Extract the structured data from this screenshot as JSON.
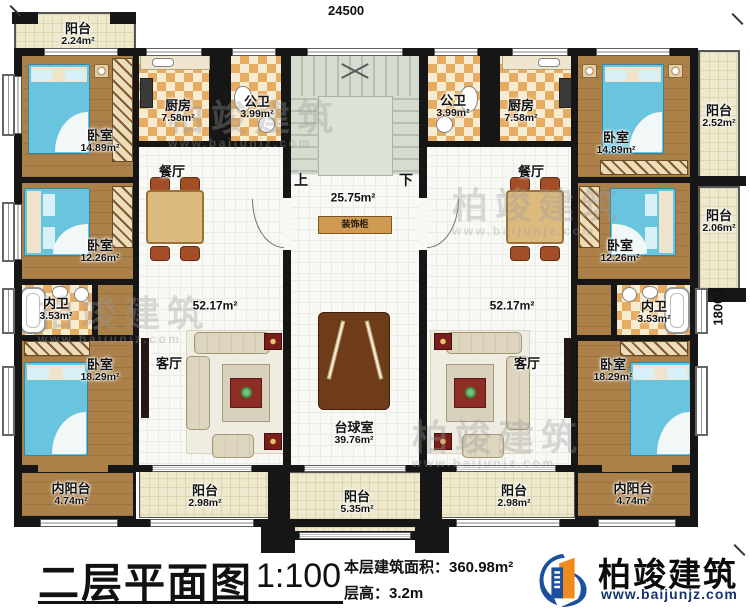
{
  "dimensions": {
    "top": "24500",
    "right": "18000"
  },
  "watermark": {
    "text": "柏竣建筑",
    "url": "www.baijunjz.com"
  },
  "hall": {
    "up": "上",
    "down": "下",
    "area": "25.75m²",
    "cabinet": "装饰柜"
  },
  "rooms": {
    "balcony_tl": {
      "name": "阳台",
      "area": "2.24m²"
    },
    "bedroom_tl": {
      "name": "卧室",
      "area": "14.89m²"
    },
    "kitchen_l": {
      "name": "厨房",
      "area": "7.58m²"
    },
    "bath_l": {
      "name": "公卫",
      "area": "3.99m²"
    },
    "dining_l": {
      "name": "餐厅"
    },
    "bedroom_ml": {
      "name": "卧室",
      "area": "12.26m²"
    },
    "living_l": {
      "name": "客厅",
      "area": "52.17m²"
    },
    "innerbath_l": {
      "name": "内卫",
      "area": "3.53m²"
    },
    "bedroom_bl": {
      "name": "卧室",
      "area": "18.29m²"
    },
    "innerbalcony_l": {
      "name": "内阳台",
      "area": "4.74m²"
    },
    "balcony_bl": {
      "name": "阳台",
      "area": "2.98m²"
    },
    "billiard": {
      "name": "台球室",
      "area": "39.76m²"
    },
    "balcony_bc": {
      "name": "阳台",
      "area": "5.35m²"
    },
    "bath_r": {
      "name": "公卫",
      "area": "3.99m²"
    },
    "kitchen_r": {
      "name": "厨房",
      "area": "7.58m²"
    },
    "bedroom_tr": {
      "name": "卧室",
      "area": "14.89m²"
    },
    "balcony_tr": {
      "name": "阳台",
      "area": "2.52m²"
    },
    "dining_r": {
      "name": "餐厅"
    },
    "bedroom_mr": {
      "name": "卧室",
      "area": "12.26m²"
    },
    "balcony_mr": {
      "name": "阳台",
      "area": "2.06m²"
    },
    "innerbath_r": {
      "name": "内卫",
      "area": "3.53m²"
    },
    "bedroom_br": {
      "name": "卧室",
      "area": "18.29m²"
    },
    "innerbalcony_r": {
      "name": "内阳台",
      "area": "4.74m²"
    },
    "balcony_br": {
      "name": "阳台",
      "area": "2.98m²"
    },
    "living_r": {
      "name": "客厅",
      "area": "52.17m²"
    }
  },
  "titleblock": {
    "title": "二层平面图",
    "scale": "1:100",
    "area_line": "本层建筑面积：360.98m²",
    "height_line": "层高：3.2m",
    "brand": "柏竣建筑",
    "brand_url": "www.baijunjz.com"
  }
}
